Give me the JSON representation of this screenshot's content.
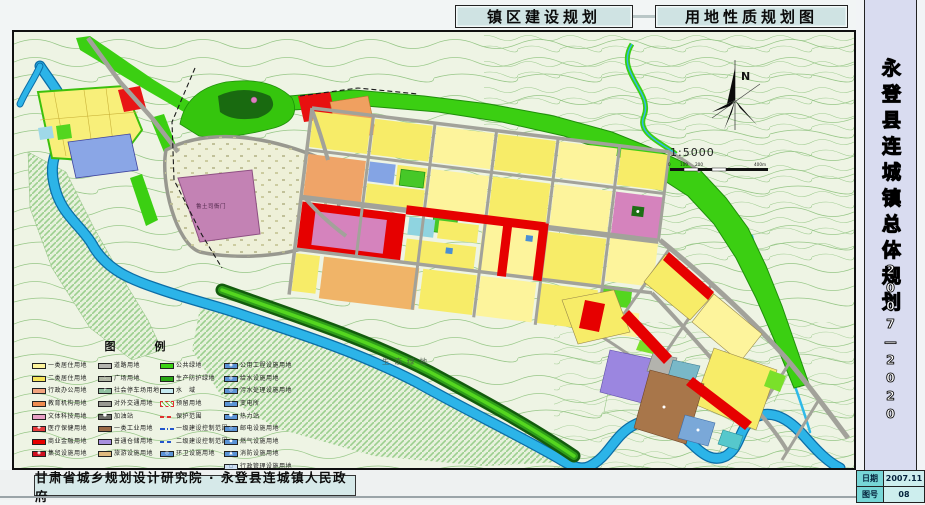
{
  "header": {
    "title_left": "镇区建设规划",
    "title_right": "用地性质规划图"
  },
  "sidebar": {
    "title": "永登县连城镇总体规划",
    "period": "2007—2020",
    "rows": [
      {
        "label": "日期",
        "value": "2007.11"
      },
      {
        "label": "图号",
        "value": "08"
      }
    ]
  },
  "footer": {
    "credit": "甘肃省城乡规划设计研究院 · 永登县连城镇人民政府"
  },
  "map": {
    "landmark": "鲁土司衙门",
    "eco_label": "生态绿地",
    "north": "N",
    "scale_text": "1:5000",
    "scale_ticks": [
      "0",
      "100",
      "200",
      "400m"
    ]
  },
  "colors": {
    "residential1": "#fdf49c",
    "residential2": "#f7ec68",
    "commercial": "#e60000",
    "green_space": "#3bcf12",
    "water": "#2cb4e8",
    "road": "#a2a29a",
    "industry": "#a8764a",
    "warehouse": "#9b86e0",
    "sidebar_panel": "#d9dcf0",
    "title_box": "#cfe3e3"
  },
  "legend": {
    "title": "图　例",
    "columns": [
      {
        "items": [
          {
            "label": "一类居住用地",
            "swatch": {
              "type": "fill",
              "color": "#fdf49c"
            }
          },
          {
            "label": "二类居住用地",
            "swatch": {
              "type": "fill",
              "color": "#f6e55a"
            }
          },
          {
            "label": "行政办公用地",
            "swatch": {
              "type": "fill",
              "color": "#f2a37e"
            }
          },
          {
            "label": "教育机构用地",
            "swatch": {
              "type": "fill",
              "color": "#ee8b50"
            }
          },
          {
            "label": "文体科技用地",
            "swatch": {
              "type": "fill",
              "color": "#e89fc6"
            }
          },
          {
            "label": "医疗保健用地",
            "swatch": {
              "type": "fill",
              "color": "#e43b3b",
              "symbol": "✚"
            }
          },
          {
            "label": "商业金融用地",
            "swatch": {
              "type": "fill",
              "color": "#e60000"
            }
          },
          {
            "label": "集贸设施用地",
            "swatch": {
              "type": "fill",
              "color": "#cf1020",
              "symbol": "◉"
            }
          }
        ]
      },
      {
        "items": [
          {
            "label": "道路用地",
            "swatch": {
              "type": "fill",
              "color": "#b5b5b0"
            }
          },
          {
            "label": "广场用地",
            "swatch": {
              "type": "fill",
              "color": "#b2b8a6",
              "symbol": "∴"
            }
          },
          {
            "label": "社会停车场用地",
            "swatch": {
              "type": "fill",
              "color": "#8fbf9f",
              "symbol": "P"
            }
          },
          {
            "label": "对外交通用地",
            "swatch": {
              "type": "fill",
              "color": "#999992"
            }
          },
          {
            "label": "加油站",
            "swatch": {
              "type": "fill",
              "color": "#6f6f6a",
              "symbol": "●"
            }
          },
          {
            "label": "一类工业用地",
            "swatch": {
              "type": "fill",
              "color": "#9c6b45"
            }
          },
          {
            "label": "普通仓储用地",
            "swatch": {
              "type": "fill",
              "color": "#a78fdf"
            }
          },
          {
            "label": "旅游设施用地",
            "swatch": {
              "type": "fill",
              "color": "#dfb97e"
            }
          }
        ]
      },
      {
        "items": [
          {
            "label": "公共绿地",
            "swatch": {
              "type": "fill",
              "color": "#3bd414"
            }
          },
          {
            "label": "生产防护绿地",
            "swatch": {
              "type": "fill",
              "color": "#28a812"
            }
          },
          {
            "label": "水　域",
            "swatch": {
              "type": "fill",
              "color": "#c6ebf2"
            }
          },
          {
            "label": "预留用地",
            "swatch": {
              "type": "hatch"
            }
          },
          {
            "label": "保护范围",
            "swatch": {
              "type": "line",
              "color": "#e03030",
              "dash": "dash"
            }
          },
          {
            "label": "一级建设控制范围",
            "swatch": {
              "type": "line",
              "color": "#2255cc",
              "dash": "dashdot"
            }
          },
          {
            "label": "二级建设控制范围",
            "swatch": {
              "type": "line",
              "color": "#2255cc",
              "dash": "dash"
            }
          },
          {
            "label": "环卫设施用地",
            "swatch": {
              "type": "fill",
              "color": "#5b93d6",
              "symbol": "◎"
            }
          }
        ]
      },
      {
        "items": [
          {
            "label": "公用工程设施用地",
            "swatch": {
              "type": "fill",
              "color": "#5b93d6",
              "symbol": "◉"
            }
          },
          {
            "label": "给水设施用地",
            "swatch": {
              "type": "fill",
              "color": "#5b93d6",
              "symbol": "◍"
            }
          },
          {
            "label": "污水处理设施用地",
            "swatch": {
              "type": "fill",
              "color": "#5b93d6",
              "symbol": "◎"
            }
          },
          {
            "label": "变电所",
            "swatch": {
              "type": "fill",
              "color": "#5b93d6",
              "symbol": "✦"
            }
          },
          {
            "label": "热力站",
            "swatch": {
              "type": "fill",
              "color": "#5b93d6",
              "symbol": "●"
            }
          },
          {
            "label": "邮电设施用地",
            "swatch": {
              "type": "fill",
              "color": "#5b93d6",
              "symbol": "◇"
            }
          },
          {
            "label": "燃气设施用地",
            "swatch": {
              "type": "fill",
              "color": "#5b93d6",
              "symbol": "◆"
            }
          },
          {
            "label": "消防设施用地",
            "swatch": {
              "type": "fill",
              "color": "#5b93d6",
              "symbol": "▲"
            }
          },
          {
            "label": "行政管理设施用地",
            "swatch": {
              "type": "fill",
              "color": "#cfe0f2",
              "symbol": "□"
            }
          }
        ]
      }
    ]
  }
}
